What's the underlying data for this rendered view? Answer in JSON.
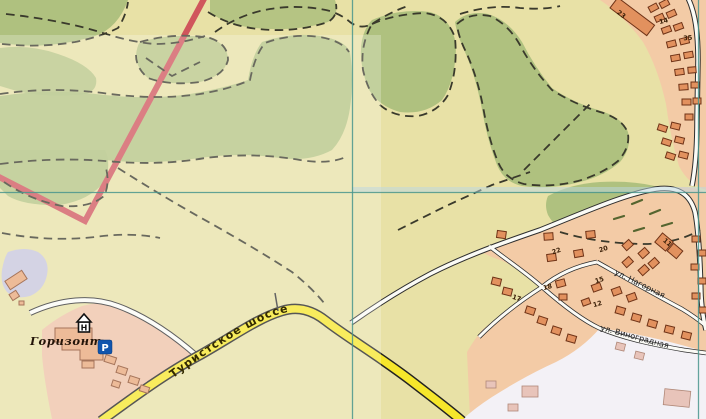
{
  "map": {
    "labels": {
      "resort": "Горизонт",
      "highway": "Туристское шоссе",
      "street_upper": "ул. Нагорная",
      "street_lower": "ул. Виноградная"
    },
    "icons": {
      "hotel_letter": "H",
      "parking_letter": "P"
    },
    "house_numbers": {
      "n23": "23",
      "n14": "14",
      "n35": "35",
      "n11": "11",
      "n22": "22",
      "n20": "20",
      "n15": "15",
      "n18": "18",
      "n12": "12",
      "n17": "17"
    },
    "colors": {
      "terrain": "#e8e1a6",
      "forest": "#afc17f",
      "residential": "#f3cba6",
      "clear_zone": "#f3f1f6",
      "resort_grounds": "#eec2a6",
      "lavender": "#c7c6dc",
      "highway_yellow": "#f6e72b",
      "boundary_red": "#d0565c",
      "grid_teal": "#4a968e",
      "building_fill": "#e2915e",
      "building_pale": "#e8c4ba",
      "parking_blue": "#1155ad"
    }
  }
}
